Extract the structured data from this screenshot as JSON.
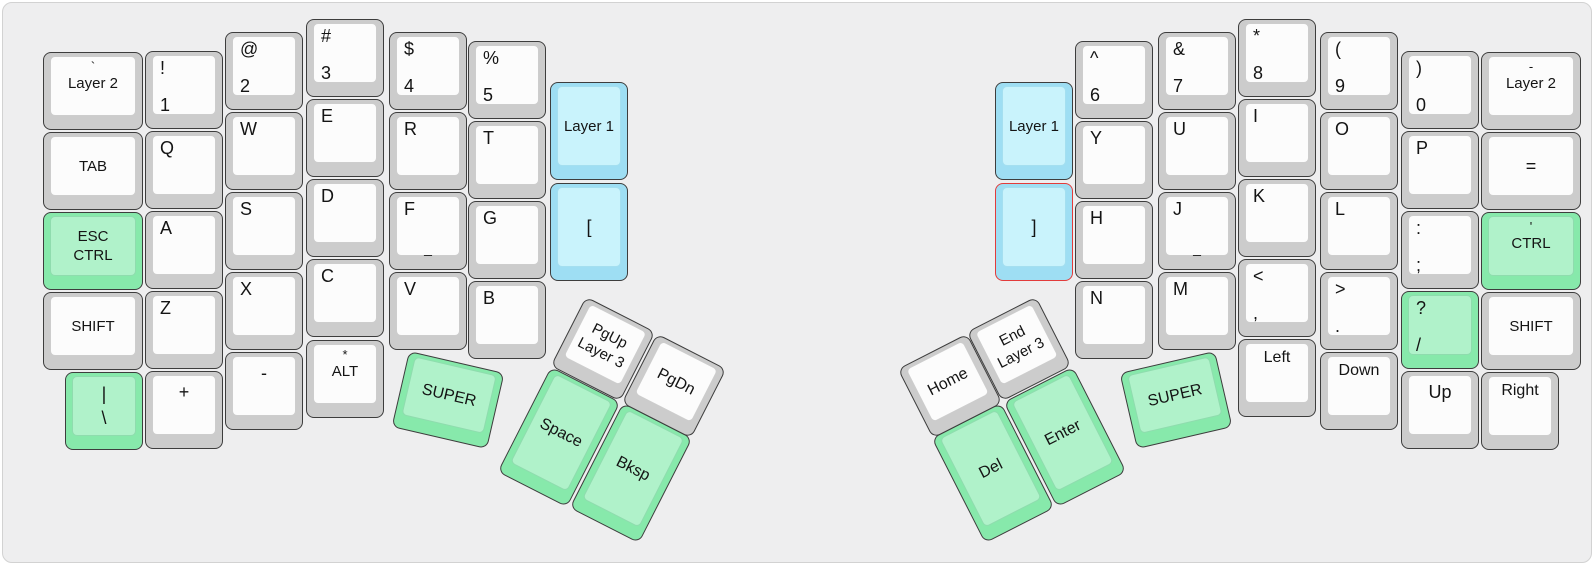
{
  "board": {
    "width": 1596,
    "height": 567,
    "background": "#eeeeef",
    "border": "#d2d2d2"
  },
  "colors": {
    "key_gray": "#cccccc",
    "cap_gray": "#fcfcfc",
    "key_green": "#87e9ab",
    "cap_green": "#b0f2ca",
    "key_blue": "#9edef3",
    "cap_blue": "#c9f3fc",
    "key_stroke": "#3d3d3d",
    "alert_stroke": "#e23b3b"
  },
  "keys": [
    {
      "id": "layer2-left",
      "x": 40,
      "y": 49,
      "w": 100,
      "h": 78,
      "color": "gray",
      "mode": "substack",
      "sub": "`",
      "lines": [
        "Layer 2"
      ]
    },
    {
      "id": "tab",
      "x": 40,
      "y": 129,
      "w": 100,
      "h": 78,
      "color": "gray",
      "mode": "center",
      "lines": [
        "TAB"
      ]
    },
    {
      "id": "esc-ctrl",
      "x": 40,
      "y": 209,
      "w": 100,
      "h": 78,
      "color": "green",
      "mode": "center",
      "lines": [
        "ESC",
        "CTRL"
      ]
    },
    {
      "id": "shift-left",
      "x": 40,
      "y": 289,
      "w": 100,
      "h": 78,
      "color": "gray",
      "mode": "center",
      "lines": [
        "SHIFT"
      ]
    },
    {
      "id": "pipe-backslash",
      "x": 62,
      "y": 369,
      "w": 78,
      "h": 78,
      "color": "green",
      "mode": "center",
      "lines": [
        "|",
        "\\"
      ]
    },
    {
      "id": "1",
      "x": 142,
      "y": 48,
      "w": 78,
      "h": 78,
      "color": "gray",
      "mode": "left",
      "lines": [
        "!",
        "1"
      ]
    },
    {
      "id": "q",
      "x": 142,
      "y": 128,
      "w": 78,
      "h": 78,
      "color": "gray",
      "mode": "left",
      "lines": [
        "Q"
      ]
    },
    {
      "id": "a",
      "x": 142,
      "y": 208,
      "w": 78,
      "h": 78,
      "color": "gray",
      "mode": "left",
      "lines": [
        "A"
      ]
    },
    {
      "id": "z",
      "x": 142,
      "y": 288,
      "w": 78,
      "h": 78,
      "color": "gray",
      "mode": "left",
      "lines": [
        "Z"
      ]
    },
    {
      "id": "plus",
      "x": 142,
      "y": 368,
      "w": 78,
      "h": 78,
      "color": "gray",
      "mode": "top",
      "lines": [
        "+"
      ]
    },
    {
      "id": "2",
      "x": 222,
      "y": 29,
      "w": 78,
      "h": 78,
      "color": "gray",
      "mode": "left",
      "lines": [
        "@",
        "2"
      ]
    },
    {
      "id": "w",
      "x": 222,
      "y": 109,
      "w": 78,
      "h": 78,
      "color": "gray",
      "mode": "left",
      "lines": [
        "W"
      ]
    },
    {
      "id": "s",
      "x": 222,
      "y": 189,
      "w": 78,
      "h": 78,
      "color": "gray",
      "mode": "left",
      "lines": [
        "S"
      ]
    },
    {
      "id": "x",
      "x": 222,
      "y": 269,
      "w": 78,
      "h": 78,
      "color": "gray",
      "mode": "left",
      "lines": [
        "X"
      ]
    },
    {
      "id": "minus",
      "x": 222,
      "y": 349,
      "w": 78,
      "h": 78,
      "color": "gray",
      "mode": "top",
      "lines": [
        "-"
      ]
    },
    {
      "id": "3",
      "x": 303,
      "y": 16,
      "w": 78,
      "h": 78,
      "color": "gray",
      "mode": "left",
      "lines": [
        "#",
        "3"
      ]
    },
    {
      "id": "e",
      "x": 303,
      "y": 96,
      "w": 78,
      "h": 78,
      "color": "gray",
      "mode": "left",
      "lines": [
        "E"
      ]
    },
    {
      "id": "d",
      "x": 303,
      "y": 176,
      "w": 78,
      "h": 78,
      "color": "gray",
      "mode": "left",
      "lines": [
        "D"
      ]
    },
    {
      "id": "c",
      "x": 303,
      "y": 256,
      "w": 78,
      "h": 78,
      "color": "gray",
      "mode": "left",
      "lines": [
        "C"
      ]
    },
    {
      "id": "alt",
      "x": 303,
      "y": 337,
      "w": 78,
      "h": 78,
      "color": "gray",
      "mode": "substack",
      "sub": "*",
      "lines": [
        "ALT"
      ]
    },
    {
      "id": "4",
      "x": 386,
      "y": 29,
      "w": 78,
      "h": 78,
      "color": "gray",
      "mode": "left",
      "lines": [
        "$",
        "4"
      ]
    },
    {
      "id": "r",
      "x": 386,
      "y": 109,
      "w": 78,
      "h": 78,
      "color": "gray",
      "mode": "left",
      "lines": [
        "R"
      ]
    },
    {
      "id": "f",
      "x": 386,
      "y": 189,
      "w": 78,
      "h": 78,
      "color": "gray",
      "mode": "left",
      "lines": [
        "F"
      ],
      "front": "_"
    },
    {
      "id": "v",
      "x": 386,
      "y": 269,
      "w": 78,
      "h": 78,
      "color": "gray",
      "mode": "left",
      "lines": [
        "V"
      ]
    },
    {
      "id": "5",
      "x": 465,
      "y": 38,
      "w": 78,
      "h": 78,
      "color": "gray",
      "mode": "left",
      "lines": [
        "%",
        "5"
      ]
    },
    {
      "id": "t",
      "x": 465,
      "y": 118,
      "w": 78,
      "h": 78,
      "color": "gray",
      "mode": "left",
      "lines": [
        "T"
      ]
    },
    {
      "id": "g",
      "x": 465,
      "y": 198,
      "w": 78,
      "h": 78,
      "color": "gray",
      "mode": "left",
      "lines": [
        "G"
      ]
    },
    {
      "id": "b",
      "x": 465,
      "y": 278,
      "w": 78,
      "h": 78,
      "color": "gray",
      "mode": "left",
      "lines": [
        "B"
      ]
    },
    {
      "id": "layer1-left",
      "x": 547,
      "y": 79,
      "w": 78,
      "h": 98,
      "color": "blue",
      "mode": "center",
      "lines": [
        "Layer 1"
      ]
    },
    {
      "id": "lbracket",
      "x": 547,
      "y": 180,
      "w": 78,
      "h": 98,
      "color": "blue",
      "mode": "center",
      "lines": [
        "["
      ]
    },
    {
      "id": "super-left",
      "x": 396,
      "y": 358,
      "w": 98,
      "h": 78,
      "rot": 13,
      "color": "green",
      "mode": "center",
      "big": true,
      "lines": [
        "SUPER"
      ]
    },
    {
      "id": "space",
      "x": 517,
      "y": 375,
      "w": 78,
      "h": 118,
      "rot": 27,
      "color": "green",
      "mode": "center",
      "big": true,
      "lines": [
        "Space"
      ]
    },
    {
      "id": "bksp",
      "x": 589,
      "y": 411,
      "w": 78,
      "h": 118,
      "rot": 27,
      "color": "green",
      "mode": "center",
      "big": true,
      "lines": [
        "Bksp"
      ]
    },
    {
      "id": "pgup-layer3",
      "x": 561,
      "y": 307,
      "w": 78,
      "h": 78,
      "rot": 27,
      "color": "gray",
      "mode": "center",
      "lines": [
        "PgUp",
        "Layer 3"
      ]
    },
    {
      "id": "pgdn",
      "x": 632,
      "y": 344,
      "w": 78,
      "h": 78,
      "rot": 27,
      "color": "gray",
      "mode": "center",
      "big": true,
      "lines": [
        "PgDn"
      ]
    },
    {
      "id": "layer1-right",
      "x": 992,
      "y": 79,
      "w": 78,
      "h": 98,
      "color": "blue",
      "mode": "center",
      "lines": [
        "Layer 1"
      ]
    },
    {
      "id": "rbracket",
      "x": 992,
      "y": 180,
      "w": 78,
      "h": 98,
      "color": "blue",
      "stroke": "red",
      "mode": "center",
      "lines": [
        "]"
      ]
    },
    {
      "id": "6",
      "x": 1072,
      "y": 38,
      "w": 78,
      "h": 78,
      "color": "gray",
      "mode": "left",
      "lines": [
        "^",
        "6"
      ]
    },
    {
      "id": "y",
      "x": 1072,
      "y": 118,
      "w": 78,
      "h": 78,
      "color": "gray",
      "mode": "left",
      "lines": [
        "Y"
      ]
    },
    {
      "id": "h",
      "x": 1072,
      "y": 198,
      "w": 78,
      "h": 78,
      "color": "gray",
      "mode": "left",
      "lines": [
        "H"
      ]
    },
    {
      "id": "n",
      "x": 1072,
      "y": 278,
      "w": 78,
      "h": 78,
      "color": "gray",
      "mode": "left",
      "lines": [
        "N"
      ]
    },
    {
      "id": "7",
      "x": 1155,
      "y": 29,
      "w": 78,
      "h": 78,
      "color": "gray",
      "mode": "left",
      "lines": [
        "&",
        "7"
      ]
    },
    {
      "id": "u",
      "x": 1155,
      "y": 109,
      "w": 78,
      "h": 78,
      "color": "gray",
      "mode": "left",
      "lines": [
        "U"
      ]
    },
    {
      "id": "j",
      "x": 1155,
      "y": 189,
      "w": 78,
      "h": 78,
      "color": "gray",
      "mode": "left",
      "lines": [
        "J"
      ],
      "front": "_"
    },
    {
      "id": "m",
      "x": 1155,
      "y": 269,
      "w": 78,
      "h": 78,
      "color": "gray",
      "mode": "left",
      "lines": [
        "M"
      ]
    },
    {
      "id": "8",
      "x": 1235,
      "y": 16,
      "w": 78,
      "h": 78,
      "color": "gray",
      "mode": "left",
      "lines": [
        "*",
        "8"
      ]
    },
    {
      "id": "i",
      "x": 1235,
      "y": 96,
      "w": 78,
      "h": 78,
      "color": "gray",
      "mode": "left",
      "lines": [
        "I"
      ]
    },
    {
      "id": "k",
      "x": 1235,
      "y": 176,
      "w": 78,
      "h": 78,
      "color": "gray",
      "mode": "left",
      "lines": [
        "K"
      ]
    },
    {
      "id": "comma",
      "x": 1235,
      "y": 256,
      "w": 78,
      "h": 78,
      "color": "gray",
      "mode": "left",
      "lines": [
        "<",
        ","
      ]
    },
    {
      "id": "arrow-left",
      "x": 1235,
      "y": 336,
      "w": 78,
      "h": 78,
      "color": "gray",
      "mode": "top",
      "lines": [
        "Left"
      ]
    },
    {
      "id": "9",
      "x": 1317,
      "y": 29,
      "w": 78,
      "h": 78,
      "color": "gray",
      "mode": "left",
      "lines": [
        "(",
        "9"
      ]
    },
    {
      "id": "o",
      "x": 1317,
      "y": 109,
      "w": 78,
      "h": 78,
      "color": "gray",
      "mode": "left",
      "lines": [
        "O"
      ]
    },
    {
      "id": "l",
      "x": 1317,
      "y": 189,
      "w": 78,
      "h": 78,
      "color": "gray",
      "mode": "left",
      "lines": [
        "L"
      ]
    },
    {
      "id": "period",
      "x": 1317,
      "y": 269,
      "w": 78,
      "h": 78,
      "color": "gray",
      "mode": "left",
      "lines": [
        ">",
        "."
      ]
    },
    {
      "id": "arrow-down",
      "x": 1317,
      "y": 349,
      "w": 78,
      "h": 78,
      "color": "gray",
      "mode": "top",
      "lines": [
        "Down"
      ]
    },
    {
      "id": "0",
      "x": 1398,
      "y": 48,
      "w": 78,
      "h": 78,
      "color": "gray",
      "mode": "left",
      "lines": [
        ")",
        "0"
      ]
    },
    {
      "id": "p",
      "x": 1398,
      "y": 128,
      "w": 78,
      "h": 78,
      "color": "gray",
      "mode": "left",
      "lines": [
        "P"
      ]
    },
    {
      "id": "semicolon",
      "x": 1398,
      "y": 208,
      "w": 78,
      "h": 78,
      "color": "gray",
      "mode": "left",
      "lines": [
        ":",
        ";"
      ]
    },
    {
      "id": "slash",
      "x": 1398,
      "y": 288,
      "w": 78,
      "h": 78,
      "color": "green",
      "mode": "left",
      "lines": [
        "?",
        "/"
      ]
    },
    {
      "id": "arrow-up",
      "x": 1398,
      "y": 368,
      "w": 78,
      "h": 78,
      "color": "gray",
      "mode": "top",
      "lines": [
        "Up"
      ]
    },
    {
      "id": "layer2-right",
      "x": 1478,
      "y": 49,
      "w": 100,
      "h": 78,
      "color": "gray",
      "mode": "substack",
      "sub": "-",
      "lines": [
        "Layer 2"
      ]
    },
    {
      "id": "equals",
      "x": 1478,
      "y": 129,
      "w": 100,
      "h": 78,
      "color": "gray",
      "mode": "center",
      "lines": [
        "="
      ]
    },
    {
      "id": "quote-ctrl",
      "x": 1478,
      "y": 209,
      "w": 100,
      "h": 78,
      "color": "green",
      "mode": "substack",
      "sub": "'",
      "lines": [
        "CTRL"
      ]
    },
    {
      "id": "shift-right",
      "x": 1478,
      "y": 289,
      "w": 100,
      "h": 78,
      "color": "gray",
      "mode": "center",
      "lines": [
        "SHIFT"
      ]
    },
    {
      "id": "arrow-right",
      "x": 1478,
      "y": 369,
      "w": 78,
      "h": 78,
      "color": "gray",
      "mode": "top",
      "lines": [
        "Right"
      ]
    },
    {
      "id": "super-right",
      "x": 1124,
      "y": 358,
      "w": 98,
      "h": 78,
      "rot": -13,
      "color": "green",
      "mode": "center",
      "big": true,
      "lines": [
        "SUPER"
      ]
    },
    {
      "id": "enter",
      "x": 1023,
      "y": 375,
      "w": 78,
      "h": 118,
      "rot": -27,
      "color": "green",
      "mode": "center",
      "big": true,
      "lines": [
        "Enter"
      ]
    },
    {
      "id": "del",
      "x": 951,
      "y": 411,
      "w": 78,
      "h": 118,
      "rot": -27,
      "color": "green",
      "mode": "center",
      "big": true,
      "lines": [
        "Del"
      ]
    },
    {
      "id": "home",
      "x": 908,
      "y": 344,
      "w": 78,
      "h": 78,
      "rot": -27,
      "color": "gray",
      "mode": "center",
      "big": true,
      "lines": [
        "Home"
      ]
    },
    {
      "id": "end-layer3",
      "x": 977,
      "y": 307,
      "w": 78,
      "h": 78,
      "rot": -27,
      "color": "gray",
      "mode": "center",
      "lines": [
        "End",
        "Layer 3"
      ]
    }
  ]
}
